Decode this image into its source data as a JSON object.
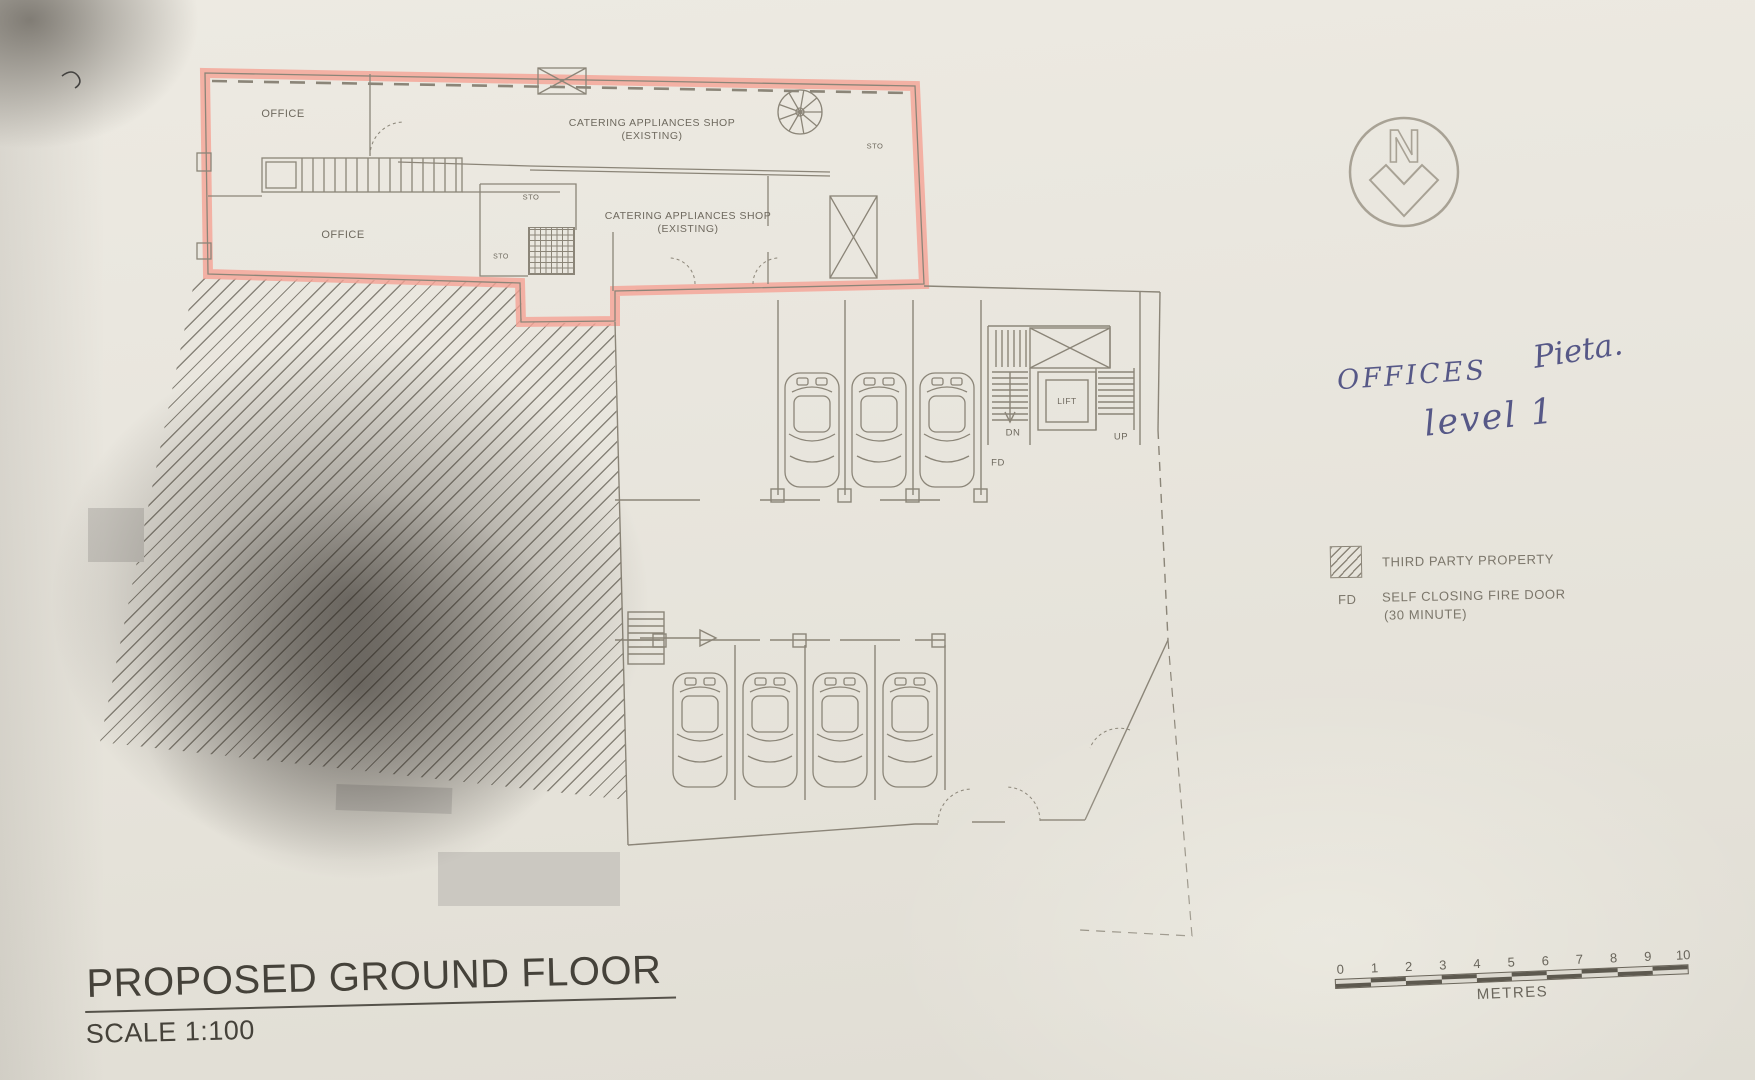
{
  "colors": {
    "highlight": "#f5a295",
    "line": "#8b8578",
    "ink": "#565887"
  },
  "plan_labels": {
    "office_top": "OFFICE",
    "office_bottom": "OFFICE",
    "catering_top_1": "CATERING APPLIANCES SHOP",
    "catering_top_2": "(EXISTING)",
    "catering_bottom_1": "CATERING APPLIANCES SHOP",
    "catering_bottom_2": "(EXISTING)",
    "sto_right": "STO",
    "sto_mid": "STO",
    "sto_small": "STO"
  },
  "garage_labels": {
    "lift": "LIFT",
    "dn": "DN",
    "up": "UP",
    "fd": "FD"
  },
  "north": {
    "letter": "N"
  },
  "annotation": {
    "word1": "OFFICES",
    "word2": "Pieta.",
    "line2": "level 1"
  },
  "legend": {
    "third_party": "THIRD PARTY PROPERTY",
    "fd_key": "FD",
    "fd_text_1": "SELF CLOSING FIRE DOOR",
    "fd_text_2": "(30 MINUTE)"
  },
  "titleblock": {
    "title": "PROPOSED GROUND FLOOR",
    "scale": "SCALE 1:100"
  },
  "scalebar": {
    "ticks": [
      "0",
      "1",
      "2",
      "3",
      "4",
      "5",
      "6",
      "7",
      "8",
      "9",
      "10"
    ],
    "unit": "METRES"
  }
}
